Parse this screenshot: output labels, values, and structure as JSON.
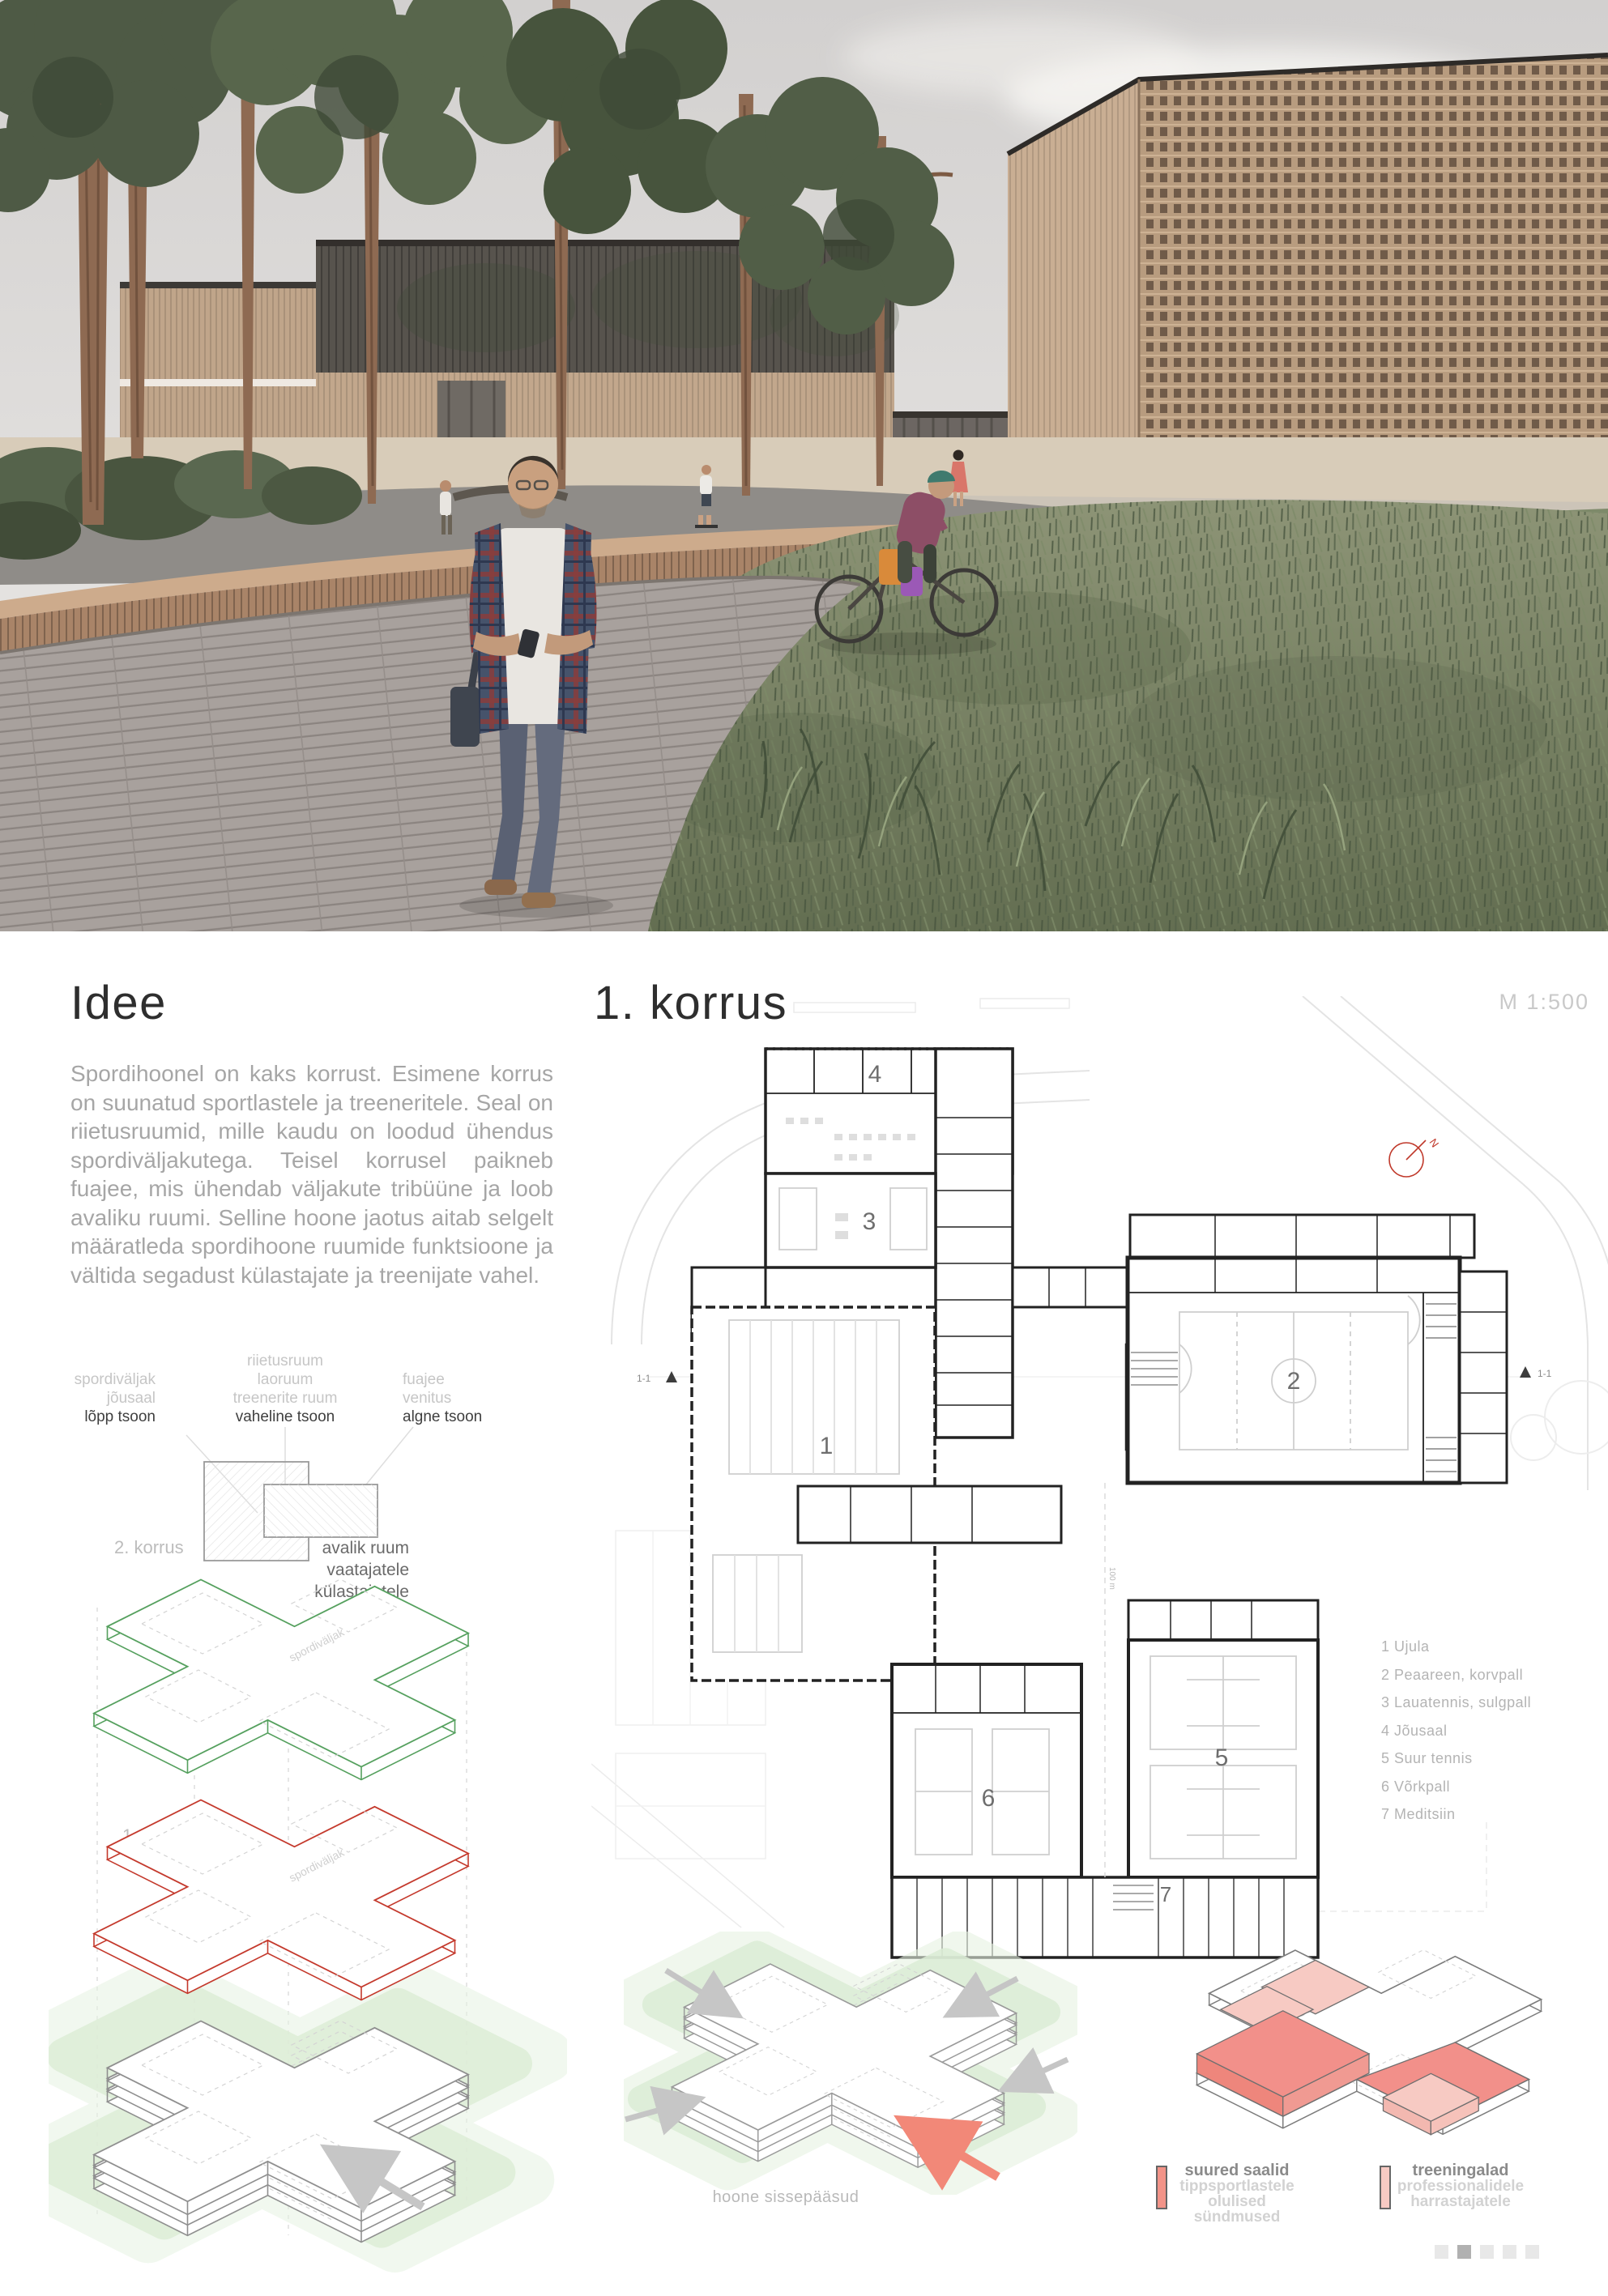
{
  "idee": {
    "title": "Idee",
    "paragraph": "Spordihoonel on kaks korrust. Esimene korrus on suunatud sportlastele ja treeneritele. Seal on riietusruumid, mille kaudu on loodud ühendus spordiväljakutega. Teisel korrusel paikneb fuajee, mis ühendab väljakute tribüüne ja loob avaliku ruumi. Selline hoone jaotus aitab selgelt määratleda spordihoone ruumide funktsioone ja vältida segadust külastajate ja treenijate vahel."
  },
  "zones": {
    "col1": {
      "muted0": "spordiväljak",
      "muted1": "jõusaal",
      "strong": "lõpp tsoon"
    },
    "col2": {
      "muted0": "riietusruum",
      "muted1": "laoruum",
      "muted2": "treenerite ruum",
      "strong": "vaheline tsoon"
    },
    "col3": {
      "muted0": "fuajee",
      "muted1": "venitus",
      "strong": "algne tsoon"
    }
  },
  "axons": {
    "floor2_label": "2. korrus",
    "floor2_desc0": "avalik ruum",
    "floor2_desc1": "vaatajatele",
    "floor2_desc2": "külastajatele",
    "floor1_label": "1. korrus",
    "floor1_desc0": "võistlejate",
    "floor1_desc1": "treenijate",
    "floor1_desc2": "treenerite tsoon",
    "watermark": "spordiväljak",
    "main_entrance": "peasissepääs"
  },
  "plan": {
    "title": "1. korrus",
    "scale": "M 1:500",
    "rooms": [
      "1",
      "2",
      "3",
      "4",
      "5",
      "6",
      "7"
    ],
    "legend": [
      "1 Ujula",
      "2 Peaareen, korvpall",
      "3 Lauatennis, sulgpall",
      "4 Jõusaal",
      "5 Suur tennis",
      "6 Võrkpall",
      "7 Meditsiin"
    ],
    "section_marker": "1-1",
    "north": "N",
    "dim": "100 m"
  },
  "bottom": {
    "entrances_label": "hoone sissepääsud",
    "legend_a": {
      "title": "suured saalid",
      "line1": "tippsportlastele",
      "line2": "olulised sündmused"
    },
    "legend_b": {
      "title": "treeningalad",
      "line1": "professionalidele",
      "line2": "harrastajatele"
    }
  },
  "pagination": {
    "count": 5,
    "active": 1
  },
  "colors": {
    "accent_green": "#55a05e",
    "accent_red": "#c4392c",
    "salmon": "#f29388",
    "salmon_light": "#f7cac3"
  }
}
